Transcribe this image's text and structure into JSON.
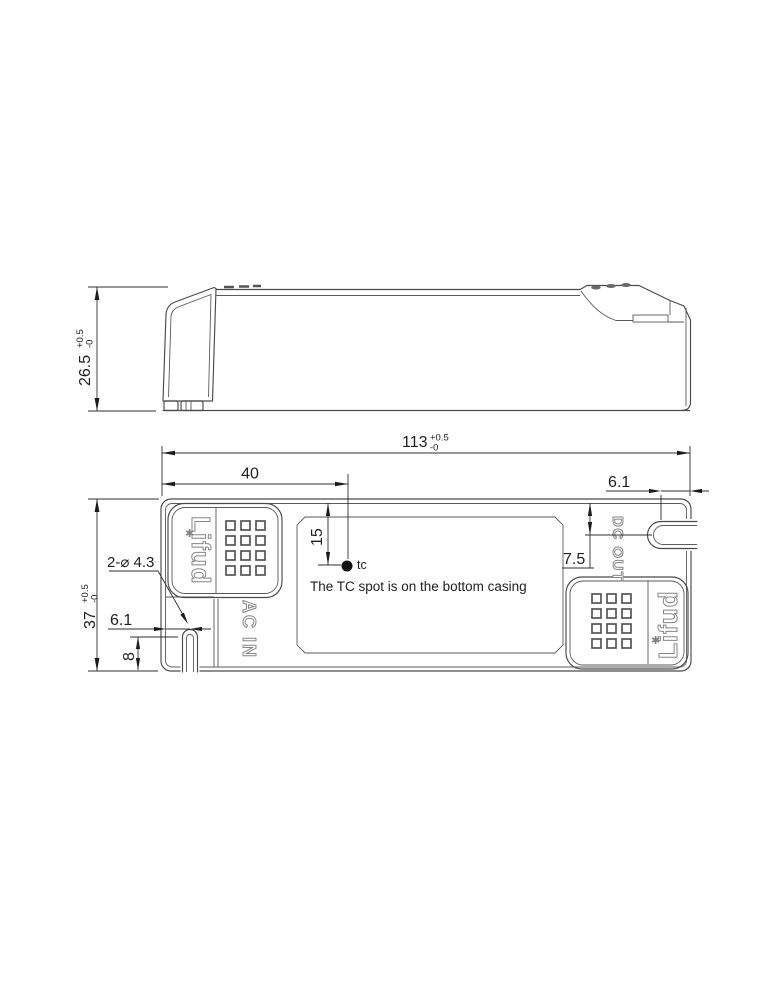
{
  "side_view": {
    "height": {
      "value": "26.5",
      "tol_plus": "+0.5",
      "tol_minus": "-0"
    }
  },
  "plan_view": {
    "length": {
      "value": "113",
      "tol_plus": "+0.5",
      "tol_minus": "-0"
    },
    "width": {
      "value": "37",
      "tol_plus": "+0.5",
      "tol_minus": "-0"
    },
    "tc_offset_from_left": "40",
    "tc_offset_from_top": "15",
    "tc_point_label": "tc",
    "tc_note": "The TC spot is on the bottom casing",
    "mounting_hole_callout": "2-⌀ 4.3",
    "left_slot_offset": "6.1",
    "left_slot_edge_distance": "8",
    "right_slot_offset": "6.1",
    "right_slot_from_top": "7.5",
    "ac_input_label": "AC IN",
    "dc_output_label": "DC OUT",
    "brand_logo_text": "Lifud",
    "logo_flower_glyph": "✱"
  },
  "colors": {
    "background": "#ffffff",
    "line": "#4a4a4a",
    "dimension": "#2f2f2f",
    "muted_label": "#878787"
  }
}
